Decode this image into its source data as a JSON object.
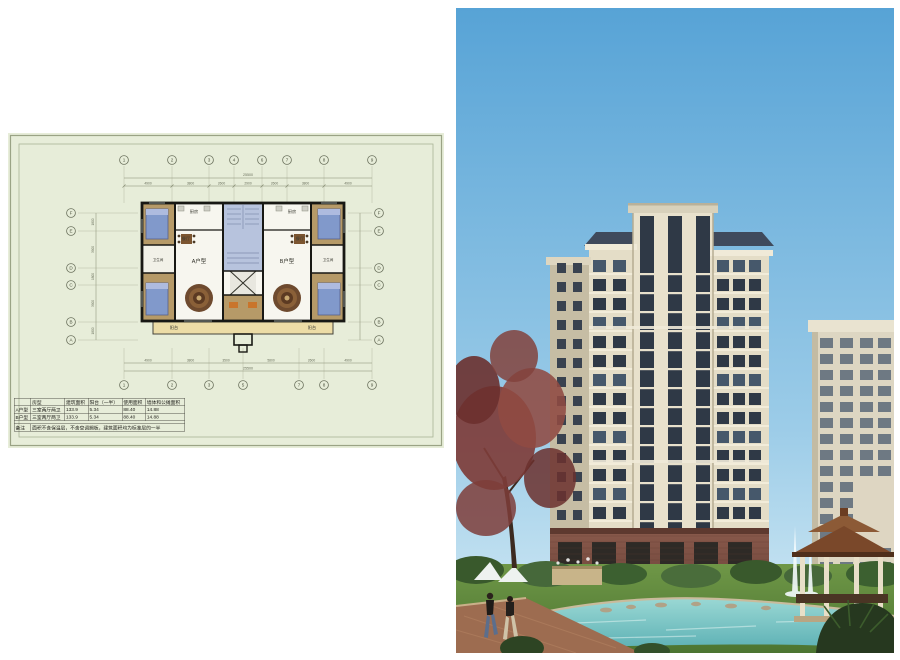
{
  "palette": {
    "sheet_bg": "#e7edd9",
    "sheet_border": "#9aa385",
    "plan_wall": "#181814",
    "plan_wood": "#b69a68",
    "plan_white": "#f7f6ef",
    "plan_stair": "#b7c3dd",
    "plan_bed": "#8199cb",
    "plan_balcony": "#ecdca6",
    "sky_top": "#57a3d6",
    "sky_bottom": "#d6ecf5",
    "facade": "#e4ddc7",
    "facade_shade": "#c6bda4",
    "pier": "#f0ead8",
    "glass": "#2f3946",
    "roof": "#3f4a5c",
    "base_brick": "#84564a",
    "lawn": "#5f8a3c",
    "water": "#7cc6c8",
    "path_brick": "#9d6c50",
    "pavilion_roof": "#7a482a",
    "tree_red": "#7e3d3a",
    "tree_green": "#46683a"
  },
  "floor_plan": {
    "top_axis": [
      "1",
      "2",
      "3",
      "4",
      "6",
      "7",
      "8",
      "9"
    ],
    "bottom_axis": [
      "1",
      "2",
      "3",
      "5",
      "7",
      "8",
      "9"
    ],
    "left_axis": [
      "F",
      "E",
      "D",
      "C",
      "B",
      "A"
    ],
    "right_axis": [
      "F",
      "E",
      "D",
      "C",
      "B",
      "A"
    ],
    "dims": {
      "top_total": "25500",
      "top_segments": [
        "4900",
        "3800",
        "2600",
        "2900",
        "2600",
        "3800",
        "4900"
      ],
      "bottom_total": "25500",
      "bottom_segments": [
        "4900",
        "3800",
        "3500",
        "5800",
        "2600",
        "4900"
      ],
      "left_total": "13200",
      "left_segments": [
        "1800",
        "3900",
        "1800",
        "3900",
        "1800"
      ]
    },
    "unit_a": "A户型",
    "unit_b": "B户型",
    "rooms": {
      "kitchen": "厨房",
      "dining": "餐厅",
      "bath": "卫生间",
      "balcony": "阳台"
    },
    "table": {
      "headers": [
        "",
        "房型",
        "建筑面积",
        "阳台（一半）",
        "使用面积",
        "墙体和公摊面积"
      ],
      "rows": [
        {
          "unit": "A户型",
          "type": "三室两厅两卫",
          "area": "133.9",
          "balcony": "5.34",
          "usable": "88.40",
          "shared": "14.88"
        },
        {
          "unit": "B户型",
          "type": "三室两厅两卫",
          "area": "133.9",
          "balcony": "5.34",
          "usable": "88.40",
          "shared": "14.88"
        }
      ],
      "note_label": "备注",
      "note": "面积不含保温层，不含空调搁板，建筑面积均为标准层的一半"
    }
  },
  "rendering": {
    "building": {
      "floors": 15,
      "tower_strips": 3,
      "wing_window_cols_left": 2,
      "wing_window_cols_right": 3
    }
  }
}
